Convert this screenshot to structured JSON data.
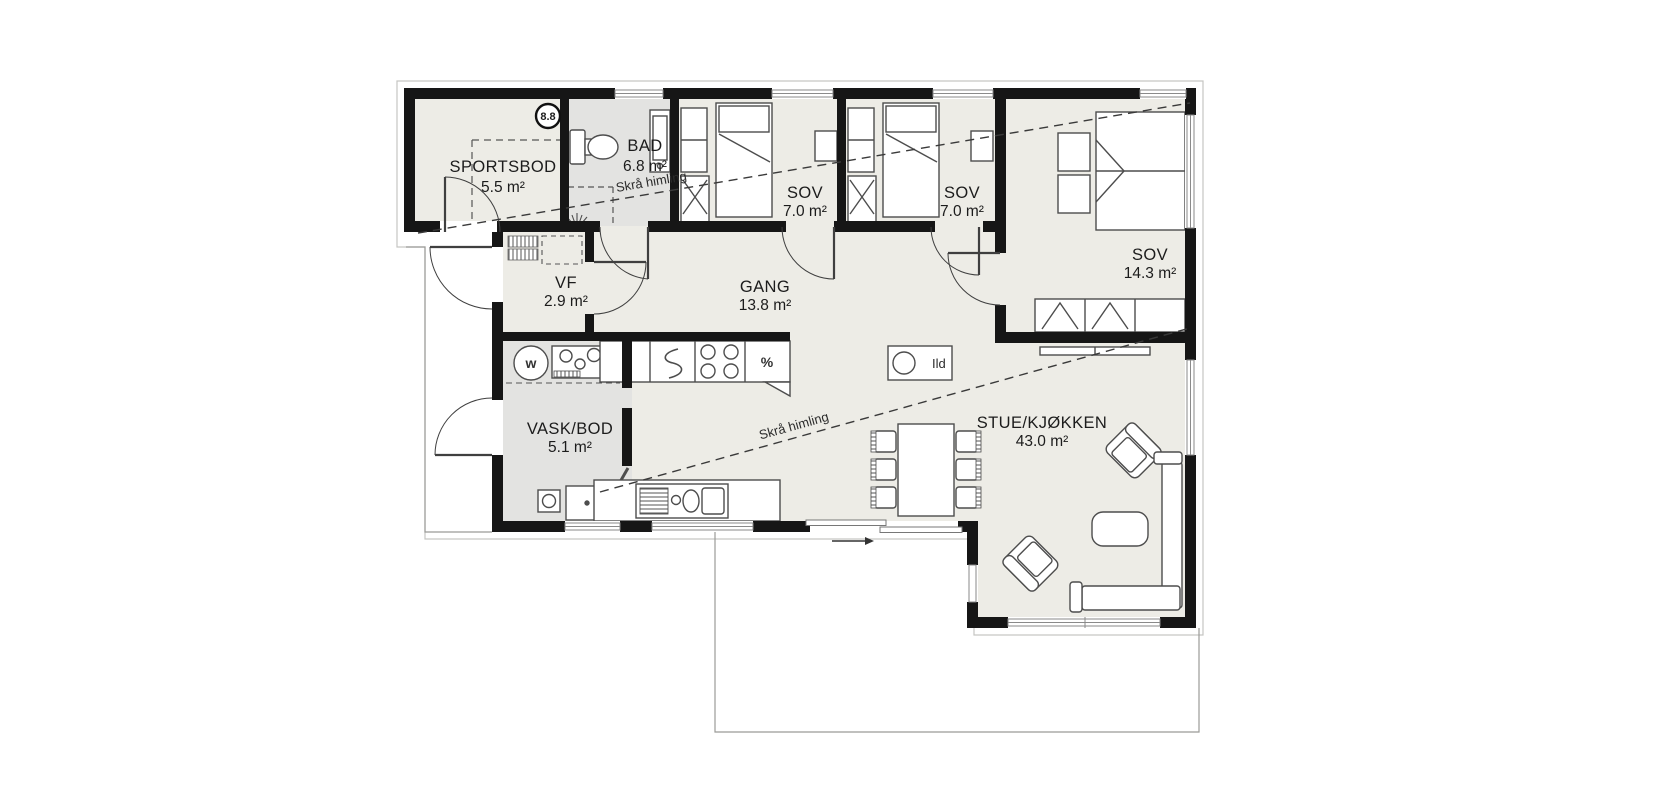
{
  "floorplan": {
    "badge": "8.8",
    "rooms": [
      {
        "name": "SPORTSBOD",
        "area": "5.5 m²"
      },
      {
        "name": "BAD",
        "area": "6.8 m²"
      },
      {
        "name": "SOV",
        "area": "7.0 m²"
      },
      {
        "name": "SOV",
        "area": "7.0 m²"
      },
      {
        "name": "SOV",
        "area": "14.3 m²"
      },
      {
        "name": "VF",
        "area": "2.9 m²"
      },
      {
        "name": "GANG",
        "area": "13.8 m²"
      },
      {
        "name": "VASK/BOD",
        "area": "5.1 m²"
      },
      {
        "name": "STUE/KJØKKEN",
        "area": "43.0 m²"
      }
    ],
    "annotations": {
      "sloped_ceiling_a": "Skrå himling",
      "sloped_ceiling_b": "Skrå himling",
      "fireplace_label": "Ild",
      "washing_machine_symbol": "w",
      "fridge_symbol": "%"
    },
    "colors": {
      "wall": "#161616",
      "floor": "#edece6",
      "wet_room_floor": "#e3e3e1",
      "background": "#ffffff",
      "furniture_line": "#4d4d4d"
    }
  }
}
